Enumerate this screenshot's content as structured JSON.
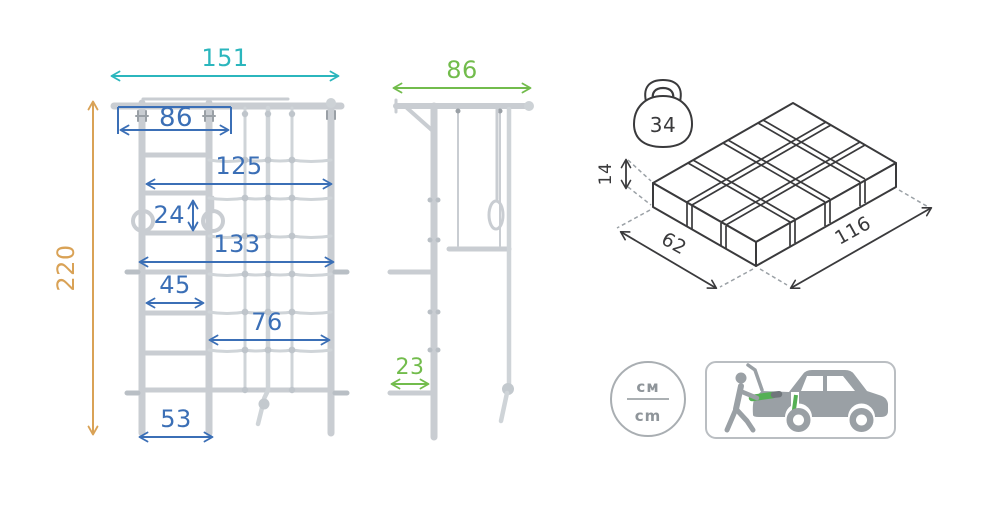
{
  "colors": {
    "teal": "#2bb6bd",
    "blue": "#3b6fb6",
    "green": "#72bc4c",
    "orange": "#d9a256",
    "structure_gray": "#c9cdd2",
    "outline_dark": "#3a3a3c",
    "icon_gray": "#9aa0a5",
    "accent_green": "#55b054"
  },
  "front_view": {
    "total_width": "151",
    "total_height": "220",
    "handle_width": "86",
    "upper_span": "125",
    "rings_size": "24",
    "mid_span": "133",
    "rung_width": "45",
    "net_span": "76",
    "base_width": "53"
  },
  "side_view": {
    "depth": "86",
    "bracket_depth": "23"
  },
  "package": {
    "weight": "34",
    "height": "14",
    "depth": "62",
    "length": "116"
  },
  "units_badge": {
    "top": "см",
    "bottom": "cm"
  }
}
